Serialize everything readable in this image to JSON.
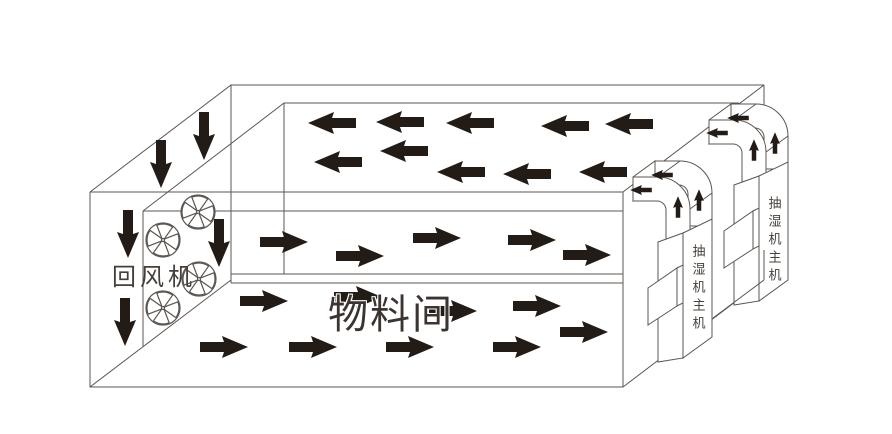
{
  "diagram": {
    "title_hint": "airflow schematic of a drying material room with dehumidifiers",
    "labels": {
      "return_fan": "回风机",
      "material_room": "物料间",
      "dehumidifier_near": "抽湿机主机",
      "dehumidifier_far": "抽湿机主机"
    },
    "colors": {
      "background": "#ffffff",
      "line": "#5b5652",
      "arrow": "#231b15",
      "text": "#46403b"
    },
    "fans": [
      {
        "x": 198,
        "y": 212
      },
      {
        "x": 163,
        "y": 240
      },
      {
        "x": 199,
        "y": 279
      },
      {
        "x": 163,
        "y": 308
      }
    ],
    "arrows": [
      {
        "group": "ceiling-plenum-flow",
        "dir": "left",
        "x": 332,
        "y": 123
      },
      {
        "group": "ceiling-plenum-flow",
        "dir": "left",
        "x": 400,
        "y": 122
      },
      {
        "group": "ceiling-plenum-flow",
        "dir": "left",
        "x": 470,
        "y": 123
      },
      {
        "group": "ceiling-plenum-flow",
        "dir": "left",
        "x": 565,
        "y": 126
      },
      {
        "group": "ceiling-plenum-flow",
        "dir": "left",
        "x": 629,
        "y": 124
      },
      {
        "group": "ceiling-plenum-flow",
        "dir": "left",
        "x": 338,
        "y": 162
      },
      {
        "group": "ceiling-plenum-flow",
        "dir": "left",
        "x": 404,
        "y": 151
      },
      {
        "group": "ceiling-plenum-flow",
        "dir": "left",
        "x": 461,
        "y": 172
      },
      {
        "group": "ceiling-plenum-flow",
        "dir": "left",
        "x": 527,
        "y": 174
      },
      {
        "group": "ceiling-plenum-flow",
        "dir": "left",
        "x": 603,
        "y": 172
      },
      {
        "group": "upper-band-flow",
        "dir": "right",
        "x": 284,
        "y": 242
      },
      {
        "group": "upper-band-flow",
        "dir": "right",
        "x": 360,
        "y": 256
      },
      {
        "group": "upper-band-flow",
        "dir": "right",
        "x": 437,
        "y": 238
      },
      {
        "group": "upper-band-flow",
        "dir": "right",
        "x": 532,
        "y": 240
      },
      {
        "group": "upper-band-flow",
        "dir": "right",
        "x": 587,
        "y": 255
      },
      {
        "group": "room-floor-flow",
        "dir": "right",
        "x": 264,
        "y": 301
      },
      {
        "group": "room-floor-flow",
        "dir": "right",
        "x": 358,
        "y": 297
      },
      {
        "group": "room-floor-flow",
        "dir": "right",
        "x": 453,
        "y": 311
      },
      {
        "group": "room-floor-flow",
        "dir": "right",
        "x": 537,
        "y": 306
      },
      {
        "group": "room-floor-flow",
        "dir": "right",
        "x": 224,
        "y": 347
      },
      {
        "group": "room-floor-flow",
        "dir": "right",
        "x": 313,
        "y": 347
      },
      {
        "group": "room-floor-flow",
        "dir": "right",
        "x": 410,
        "y": 347
      },
      {
        "group": "room-floor-flow",
        "dir": "right",
        "x": 517,
        "y": 347
      },
      {
        "group": "room-floor-flow",
        "dir": "right",
        "x": 584,
        "y": 332
      },
      {
        "group": "return-down-flow",
        "dir": "down",
        "x": 161,
        "y": 164
      },
      {
        "group": "return-down-flow",
        "dir": "down",
        "x": 204,
        "y": 136
      },
      {
        "group": "return-down-flow",
        "dir": "down",
        "x": 128,
        "y": 234
      },
      {
        "group": "return-down-flow",
        "dir": "down",
        "x": 219,
        "y": 243
      },
      {
        "group": "return-down-flow",
        "dir": "down",
        "x": 125,
        "y": 322
      },
      {
        "group": "duct-flow",
        "dir": "left",
        "x": 641,
        "y": 190,
        "scale": 0.45
      },
      {
        "group": "duct-flow",
        "dir": "left",
        "x": 662,
        "y": 175,
        "scale": 0.45
      },
      {
        "group": "duct-flow",
        "dir": "up",
        "x": 678,
        "y": 207,
        "scale": 0.45
      },
      {
        "group": "duct-flow",
        "dir": "up",
        "x": 699,
        "y": 200,
        "scale": 0.45
      },
      {
        "group": "duct-flow",
        "dir": "left",
        "x": 717,
        "y": 133,
        "scale": 0.45
      },
      {
        "group": "duct-flow",
        "dir": "left",
        "x": 738,
        "y": 118,
        "scale": 0.45
      },
      {
        "group": "duct-flow",
        "dir": "up",
        "x": 754,
        "y": 150,
        "scale": 0.45
      },
      {
        "group": "duct-flow",
        "dir": "up",
        "x": 775,
        "y": 143,
        "scale": 0.45
      }
    ]
  }
}
